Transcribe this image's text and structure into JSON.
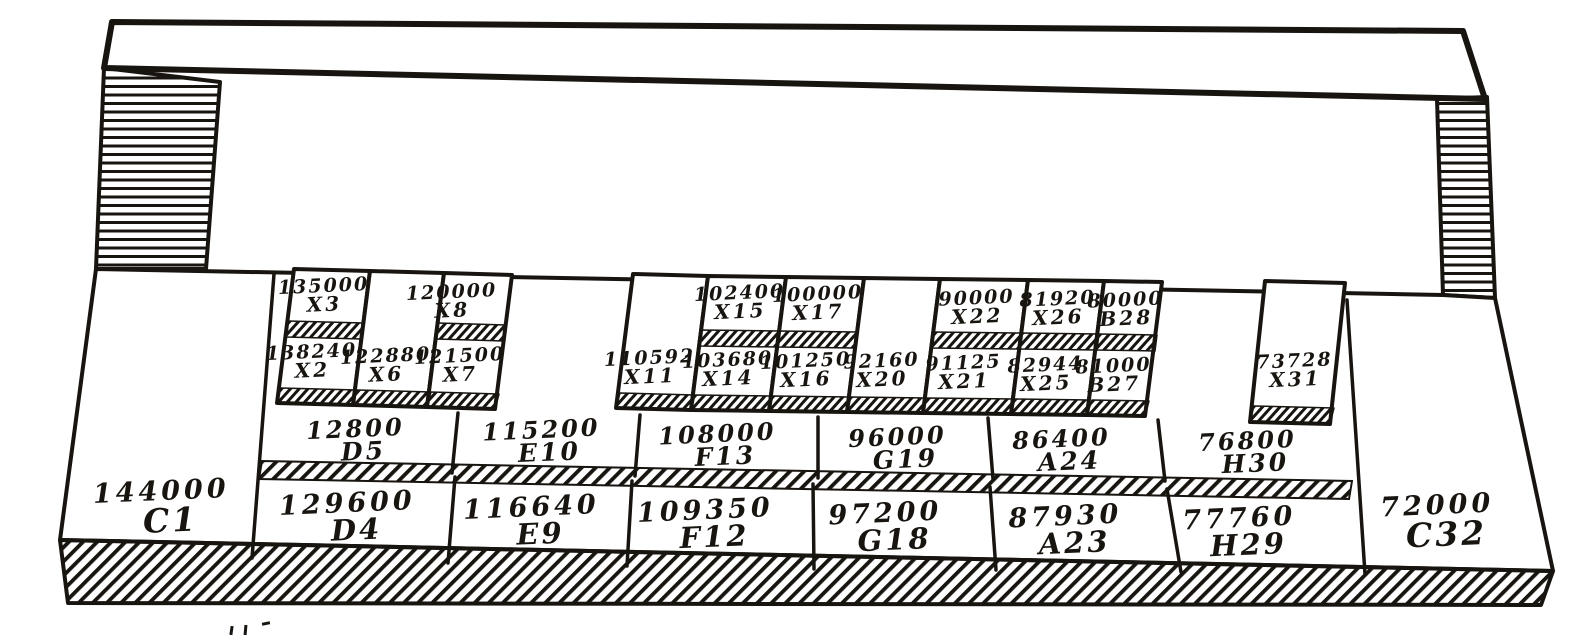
{
  "palette": {
    "ink": "#181410",
    "paper": "#ffffff"
  },
  "keyboard": {
    "description_visible_text_only": "",
    "upper_sharp_row": [
      {
        "value": "135000",
        "label": "X3"
      },
      {
        "value": "120000",
        "label": "X8"
      },
      {
        "value": "102400",
        "label": "X15"
      },
      {
        "value": "100000",
        "label": "X17"
      },
      {
        "value": "90000",
        "label": "X22"
      },
      {
        "value": "81920",
        "label": "X26"
      },
      {
        "value": "80000",
        "label": "B28"
      }
    ],
    "lower_sharp_row": [
      {
        "value": "138240",
        "label": "X2"
      },
      {
        "value": "122880",
        "label": "X6"
      },
      {
        "value": "121500",
        "label": "X7"
      },
      {
        "value": "110592",
        "label": "X11"
      },
      {
        "value": "103680",
        "label": "X14"
      },
      {
        "value": "101250",
        "label": "X16"
      },
      {
        "value": "92160",
        "label": "X20"
      },
      {
        "value": "91125",
        "label": "X21"
      },
      {
        "value": "82944",
        "label": "X25"
      },
      {
        "value": "81000",
        "label": "B27"
      },
      {
        "value": "73728",
        "label": "X31"
      }
    ],
    "back_natural_row": [
      {
        "value": "12800",
        "label": "D5"
      },
      {
        "value": "115200",
        "label": "E10"
      },
      {
        "value": "108000",
        "label": "F13"
      },
      {
        "value": "96000",
        "label": "G19"
      },
      {
        "value": "86400",
        "label": "A24"
      },
      {
        "value": "76800",
        "label": "H30"
      }
    ],
    "front_natural_row": [
      {
        "value": "144000",
        "label": "C1"
      },
      {
        "value": "129600",
        "label": "D4"
      },
      {
        "value": "116640",
        "label": "E9"
      },
      {
        "value": "109350",
        "label": "F12"
      },
      {
        "value": "97200",
        "label": "G18"
      },
      {
        "value": "87930",
        "label": "A23"
      },
      {
        "value": "77760",
        "label": "H29"
      },
      {
        "value": "72000",
        "label": "C32"
      }
    ]
  }
}
